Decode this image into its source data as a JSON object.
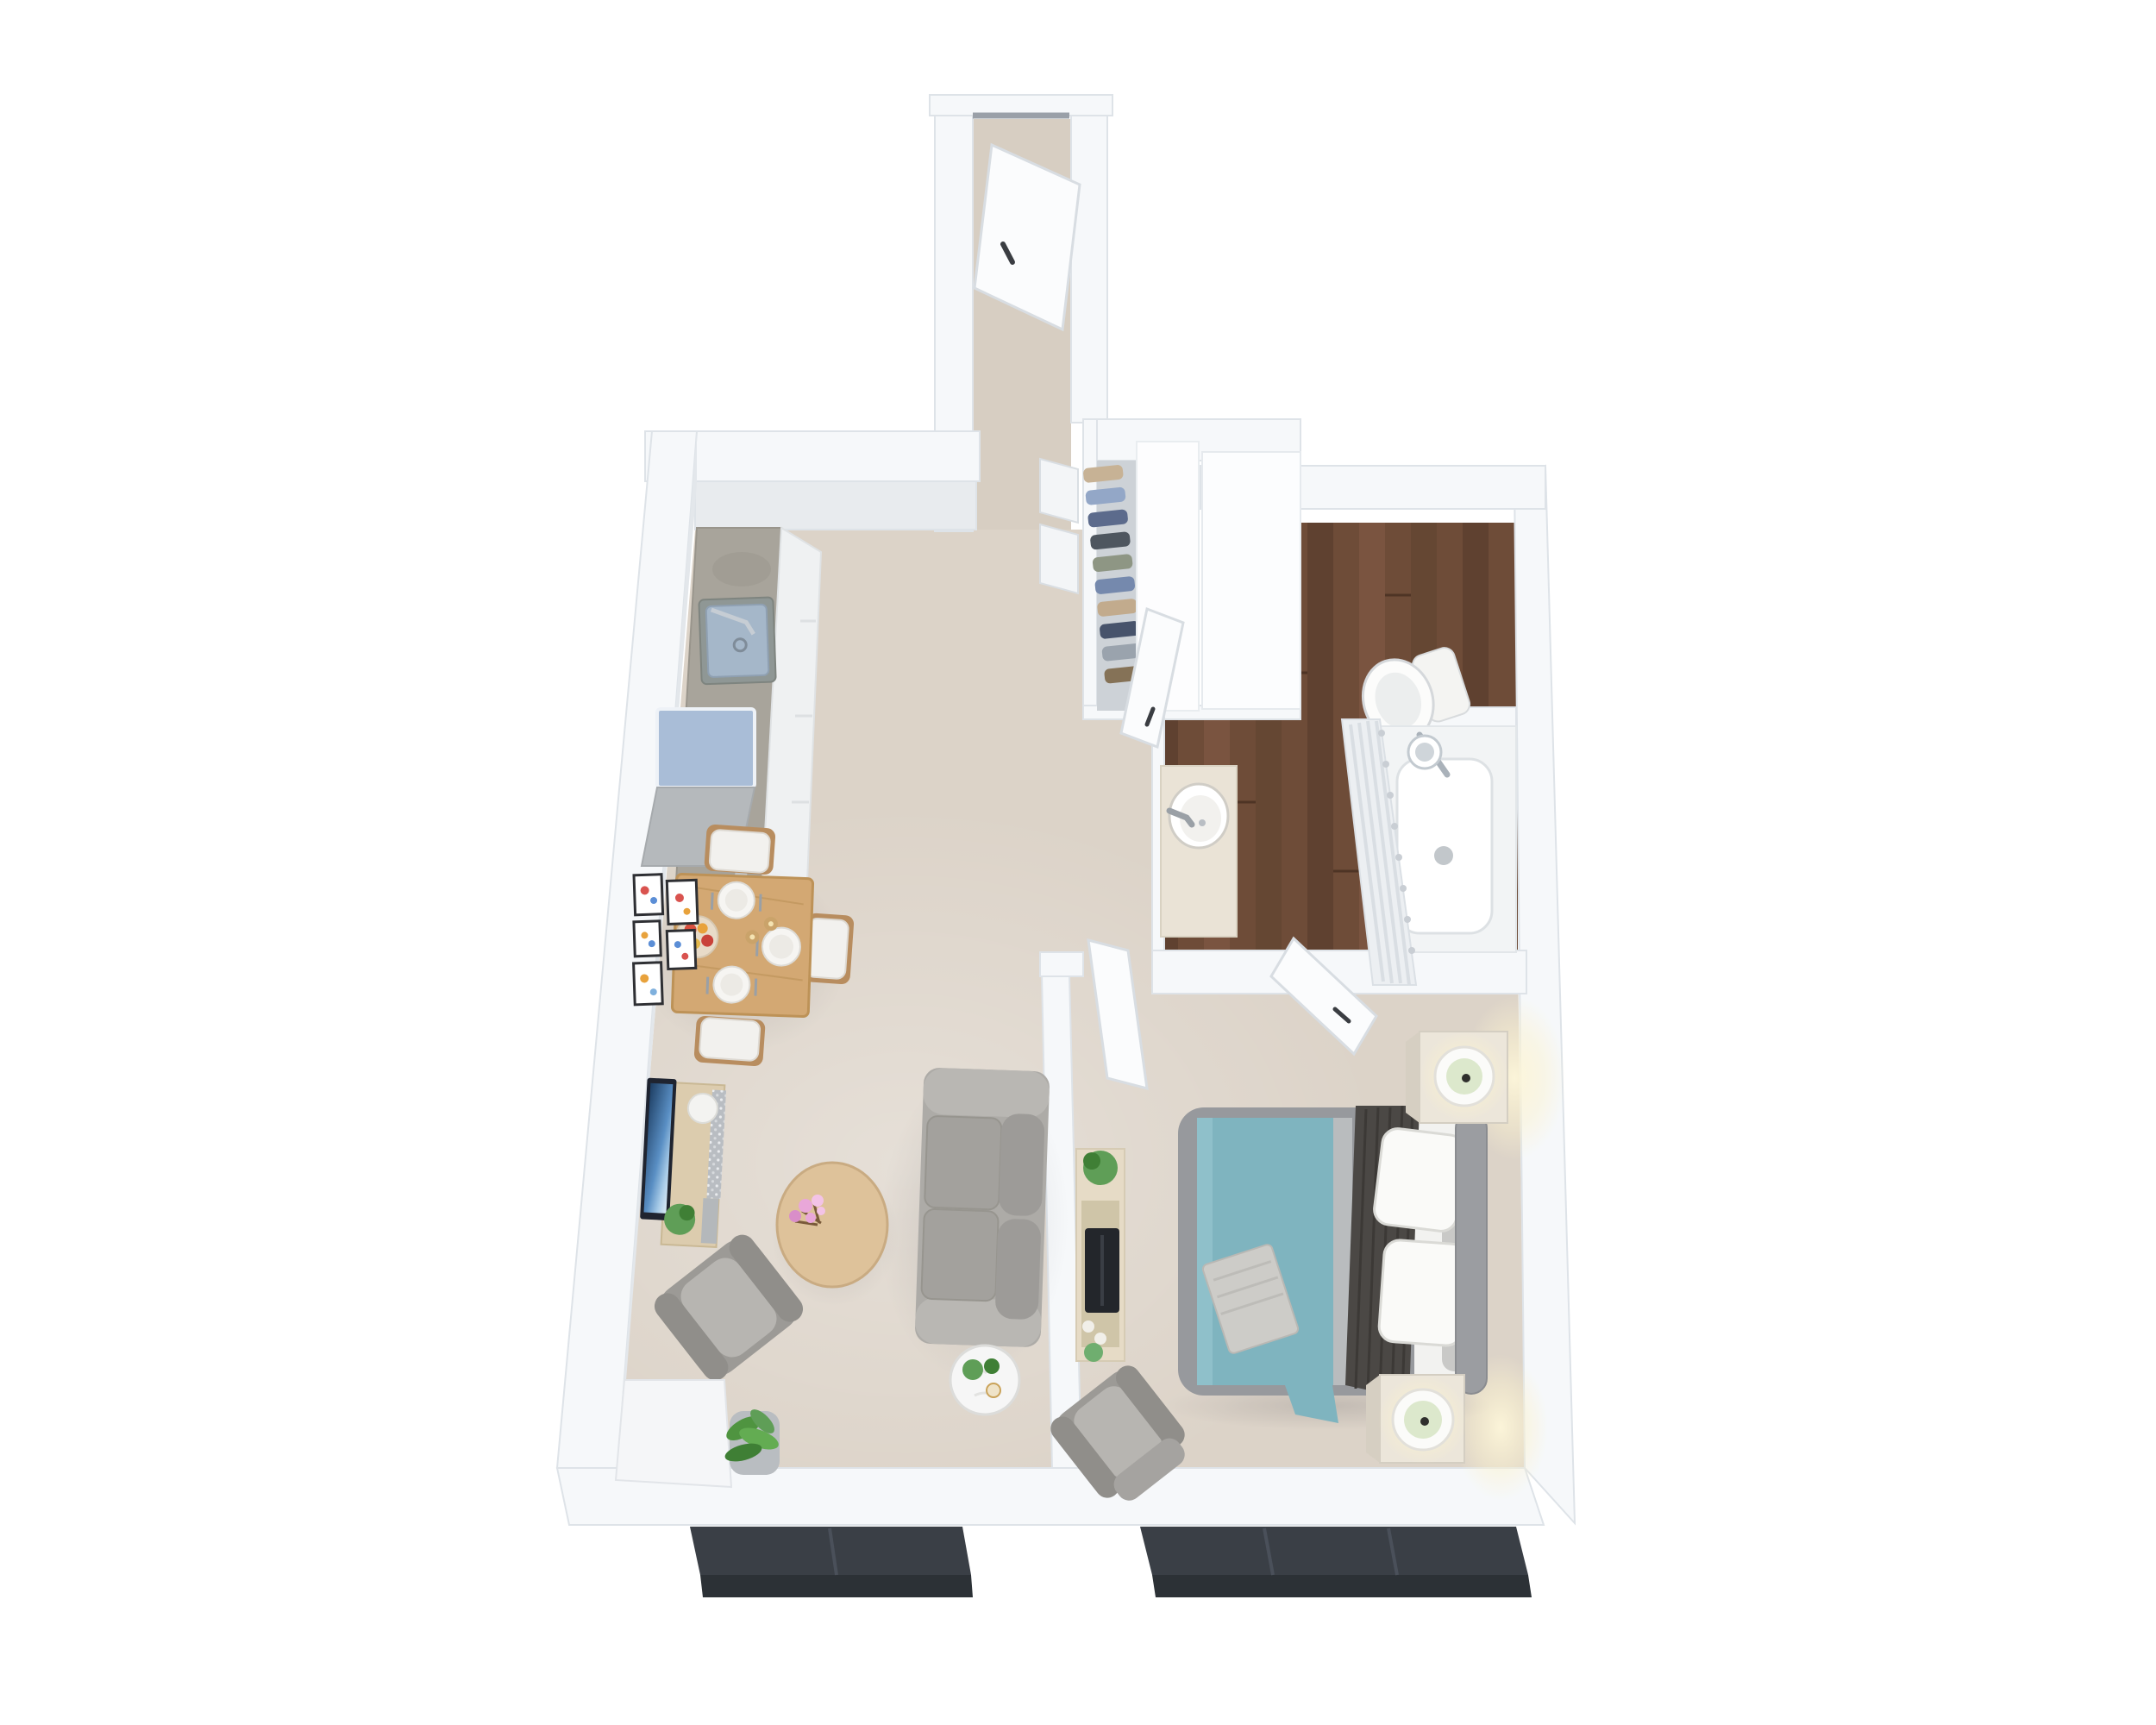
{
  "title": "3D top-down floor plan of a one-bedroom apartment",
  "palette": {
    "background": "#ffffff",
    "wall": "#f6f8fa",
    "wall_bright": "#fdfeff",
    "wall_inner": "#e7ebee",
    "wall_shadow": "#d7dce1",
    "carpet": "#dcd3c8",
    "carpet_hall": "#d7cec2",
    "wood_a": "#6e4c38",
    "wood_b": "#5f4130",
    "wood_c": "#7a5440",
    "wood_d": "#654733",
    "counter_concrete": "#a8a49b",
    "cabinet_white": "#eff1f2",
    "appliance_blue": "#a9bdd7",
    "appliance_steel": "#b5b9bc",
    "sink_basin": "#a5b7c9",
    "sink_rim": "#8f9795",
    "dining_table_wood": "#d3a873",
    "coffee_table_wood": "#dec29a",
    "console_wood": "#dcccae",
    "bedroom_console_wood": "#e6dbc6",
    "sofa_gray": "#adaba7",
    "sofa_cushion": "#a3a19d",
    "sofa_back": "#9d9b98",
    "armchair_gray": "#9c9a96",
    "armchair_seat": "#b7b5b1",
    "bed_frame": "#97999d",
    "headboard": "#9b9da1",
    "duvet_teal": "#7fb4bf",
    "duvet_fold": "#8fc0ca",
    "sheet_gray_band": "#b9bcbe",
    "throw_dark": "#4b4845",
    "blanket_folded": "#cdccc8",
    "sheet_white": "#f2f2f0",
    "pillow_white": "#fafaf8",
    "nightstand_cream": "#ece6da",
    "nightstand_side": "#d6cfc2",
    "lamp_ring": "#fbfbf9",
    "lamp_green": "#dce8cc",
    "plant_green": "#5f9e57",
    "plant_dark": "#3f7f35",
    "planter_gray": "#b9bdc1",
    "flower_pink": "#e9a7d9",
    "flower_pink_light": "#f3c3e6",
    "tv_dark": "#1f2430",
    "window_sill": "#3a3f46",
    "window_sill_face": "#2c3136",
    "door_white": "#fbfcfd",
    "door_edge": "#dfe3e8",
    "handle_dark": "#3a3d42",
    "marble_vanity": "#eae3d6",
    "curtain": "#eceff2",
    "curtain_fold": "#d9dee3",
    "tub_white": "#fdfdfe",
    "tub_shell": "#f2f4f5",
    "toilet_white": "#fcfcfb",
    "plate_white": "#f6f5f2",
    "fruit_bowl": "#e8dbc8",
    "apple_red": "#d94f3e",
    "apple_yellow": "#e8a23c",
    "candle_brass": "#caa36a",
    "art_red": "#d9534f",
    "art_blue": "#5b8ed6",
    "art_orange": "#e8a23c",
    "side_table_marble": "#f6f6f6",
    "chair_cushion": "#f2f1ee",
    "chair_frame": "#b88d5f",
    "sequin_base": "#b9bdc2"
  },
  "closet": {
    "clothes": [
      "#c7b295",
      "#93a7c7",
      "#5c6b8c",
      "#4e565f",
      "#8e9684",
      "#7589ad",
      "#c2ab8d",
      "#47536b",
      "#9aa3ad",
      "#857257"
    ]
  },
  "semantics": {
    "floorplan": "3D apartment floor plan, top view",
    "entry_hall": "entry hallway with open front door",
    "front_door": "open front door",
    "kitchen": "kitchen with concrete counter, sink and range",
    "dining_area": "dining table for four with place settings",
    "wall_art": "gallery of small framed art prints",
    "living_room": "living room with sofa, coffee table and TV console",
    "closet": "open closet with hanging clothes",
    "bathroom": "bathroom with wood floor, vanity, toilet and tub",
    "bedroom": "bedroom with double bed, nightstands and recliner",
    "windows": "dark exterior window sills"
  }
}
